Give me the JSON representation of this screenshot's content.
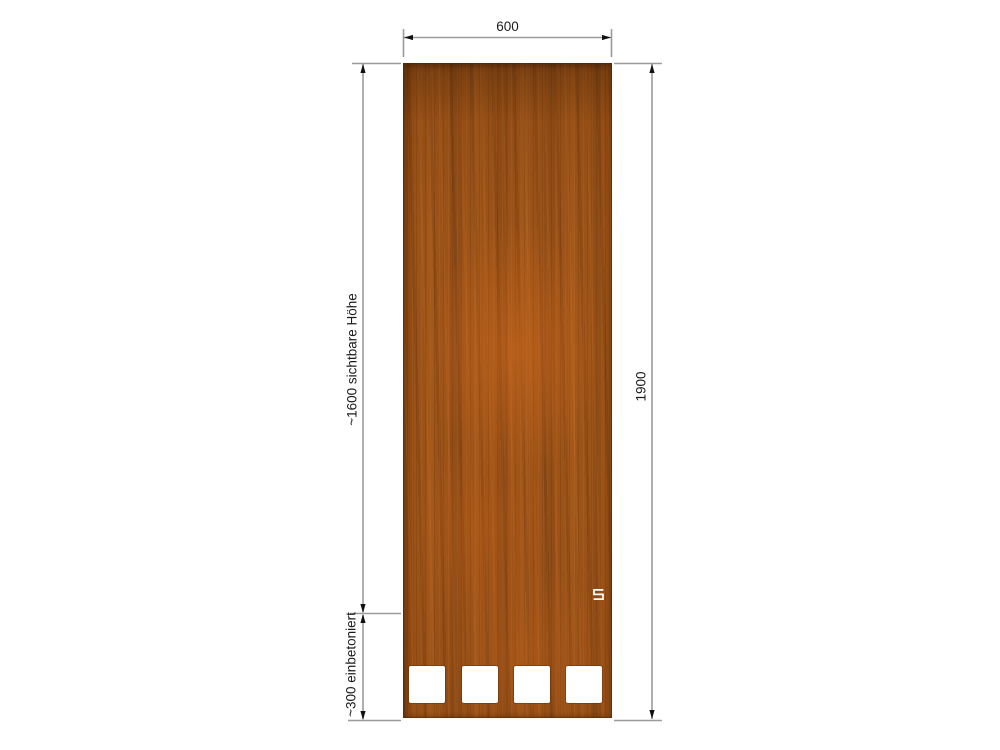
{
  "drawing": {
    "type": "technical-dimension-drawing",
    "subject": "corten steel privacy screen panel with four square cutouts",
    "labels": {
      "width": "600",
      "total_height": "1900",
      "visible_height": "~1600 sichtbare Höhe",
      "embedded_depth": "~300 einbetoniert"
    },
    "panel": {
      "cutout_count": 4,
      "logo": "brand-s-glyph"
    },
    "colors": {
      "corten_base": "#9c5318",
      "corten_dark": "#6e3709",
      "corten_light": "#c1681d",
      "cutout": "#ffffff",
      "dimension_line": "#9b9b9b",
      "arrow": "#111111",
      "text": "#1c1c1c",
      "background": "#ffffff"
    }
  }
}
